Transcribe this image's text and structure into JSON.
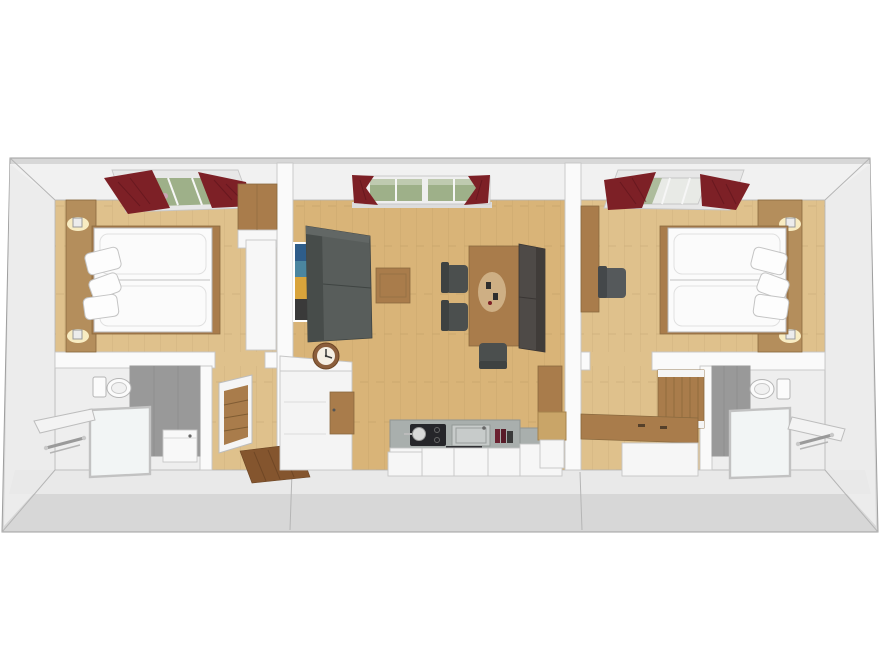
{
  "scene": {
    "name": "top-down 3d floor plan render of a three-unit apartment",
    "units": [
      "left bedroom suite",
      "central living room with kitchenette",
      "right bedroom suite"
    ]
  },
  "colors": {
    "background": "#ffffff",
    "wall_outer": "#d7d7d7",
    "ceiling_band": "#f1f1f1",
    "wall_face": "#ececec",
    "wall_inner": "#fafafa",
    "floor_wood_bedroom": "#dfc18c",
    "floor_wood_living": "#d9b478",
    "floor_bath": "#eeeeee",
    "wood_panel": "#b48e5c",
    "wood_furniture": "#a97c4b",
    "wood_step": "#c9a568",
    "wood_dark": "#84552e",
    "sofa": "#585d5b",
    "sofa_dark": "#474c4a",
    "bench": "#4e4a47",
    "chair": "#4b4f4e",
    "curtain": "#7d2026",
    "window_green": "#9eb089",
    "skylight_glass": "#e8eae6",
    "tile": "#999999",
    "counter": "#a9afad",
    "cooktop": "#26262a",
    "cabinet": "#f6f6f6",
    "clock_ring": "#8b5e3c",
    "clock_face": "#f5efe4",
    "art_blue": "#2e5d8a",
    "art_teal": "#4b86a0",
    "art_yellow": "#d9a43b",
    "art_dark": "#3a3a3a",
    "lamp_glow": "#f8ecc2",
    "bottle_red": "#6b2231"
  },
  "rooms": {
    "left_bedroom": {
      "name": "left bedroom",
      "furniture": [
        "roof window with red curtains",
        "wood headboard panel",
        "two wall lamps",
        "double bed with two mattresses",
        "three pillows",
        "wardrobe",
        "white dresser"
      ]
    },
    "left_bathroom": {
      "name": "left bathroom",
      "furniture": [
        "toilet",
        "walk-in shower with glass door",
        "towel radiator",
        "washbasin cabinet",
        "gray tiled wall"
      ]
    },
    "left_hall": {
      "name": "left entry hall",
      "furniture": [
        "drawer dresser",
        "dark wood entrance mat"
      ]
    },
    "living_room": {
      "name": "living room with kitchenette",
      "furniture": [
        "window with red curtains",
        "wall picture",
        "gray sofa",
        "coffee table",
        "dining table",
        "two dining chairs",
        "side chair",
        "wall bench",
        "sideboard with clock",
        "kitchenette with cooktop, sink and oven",
        "wood step"
      ]
    },
    "right_bedroom": {
      "name": "right bedroom",
      "furniture": [
        "roof window with red curtains",
        "desk",
        "desk chair",
        "double bed with two mattresses",
        "three pillows",
        "wood headboard panel",
        "two wall lamps"
      ]
    },
    "right_hall": {
      "name": "right entry hall",
      "furniture": [
        "wall mounted wardrobe",
        "storage bench"
      ]
    },
    "right_bathroom": {
      "name": "right bathroom",
      "furniture": [
        "toilet",
        "walk-in shower with glass door",
        "towel radiator",
        "gray tiled wall"
      ]
    }
  }
}
